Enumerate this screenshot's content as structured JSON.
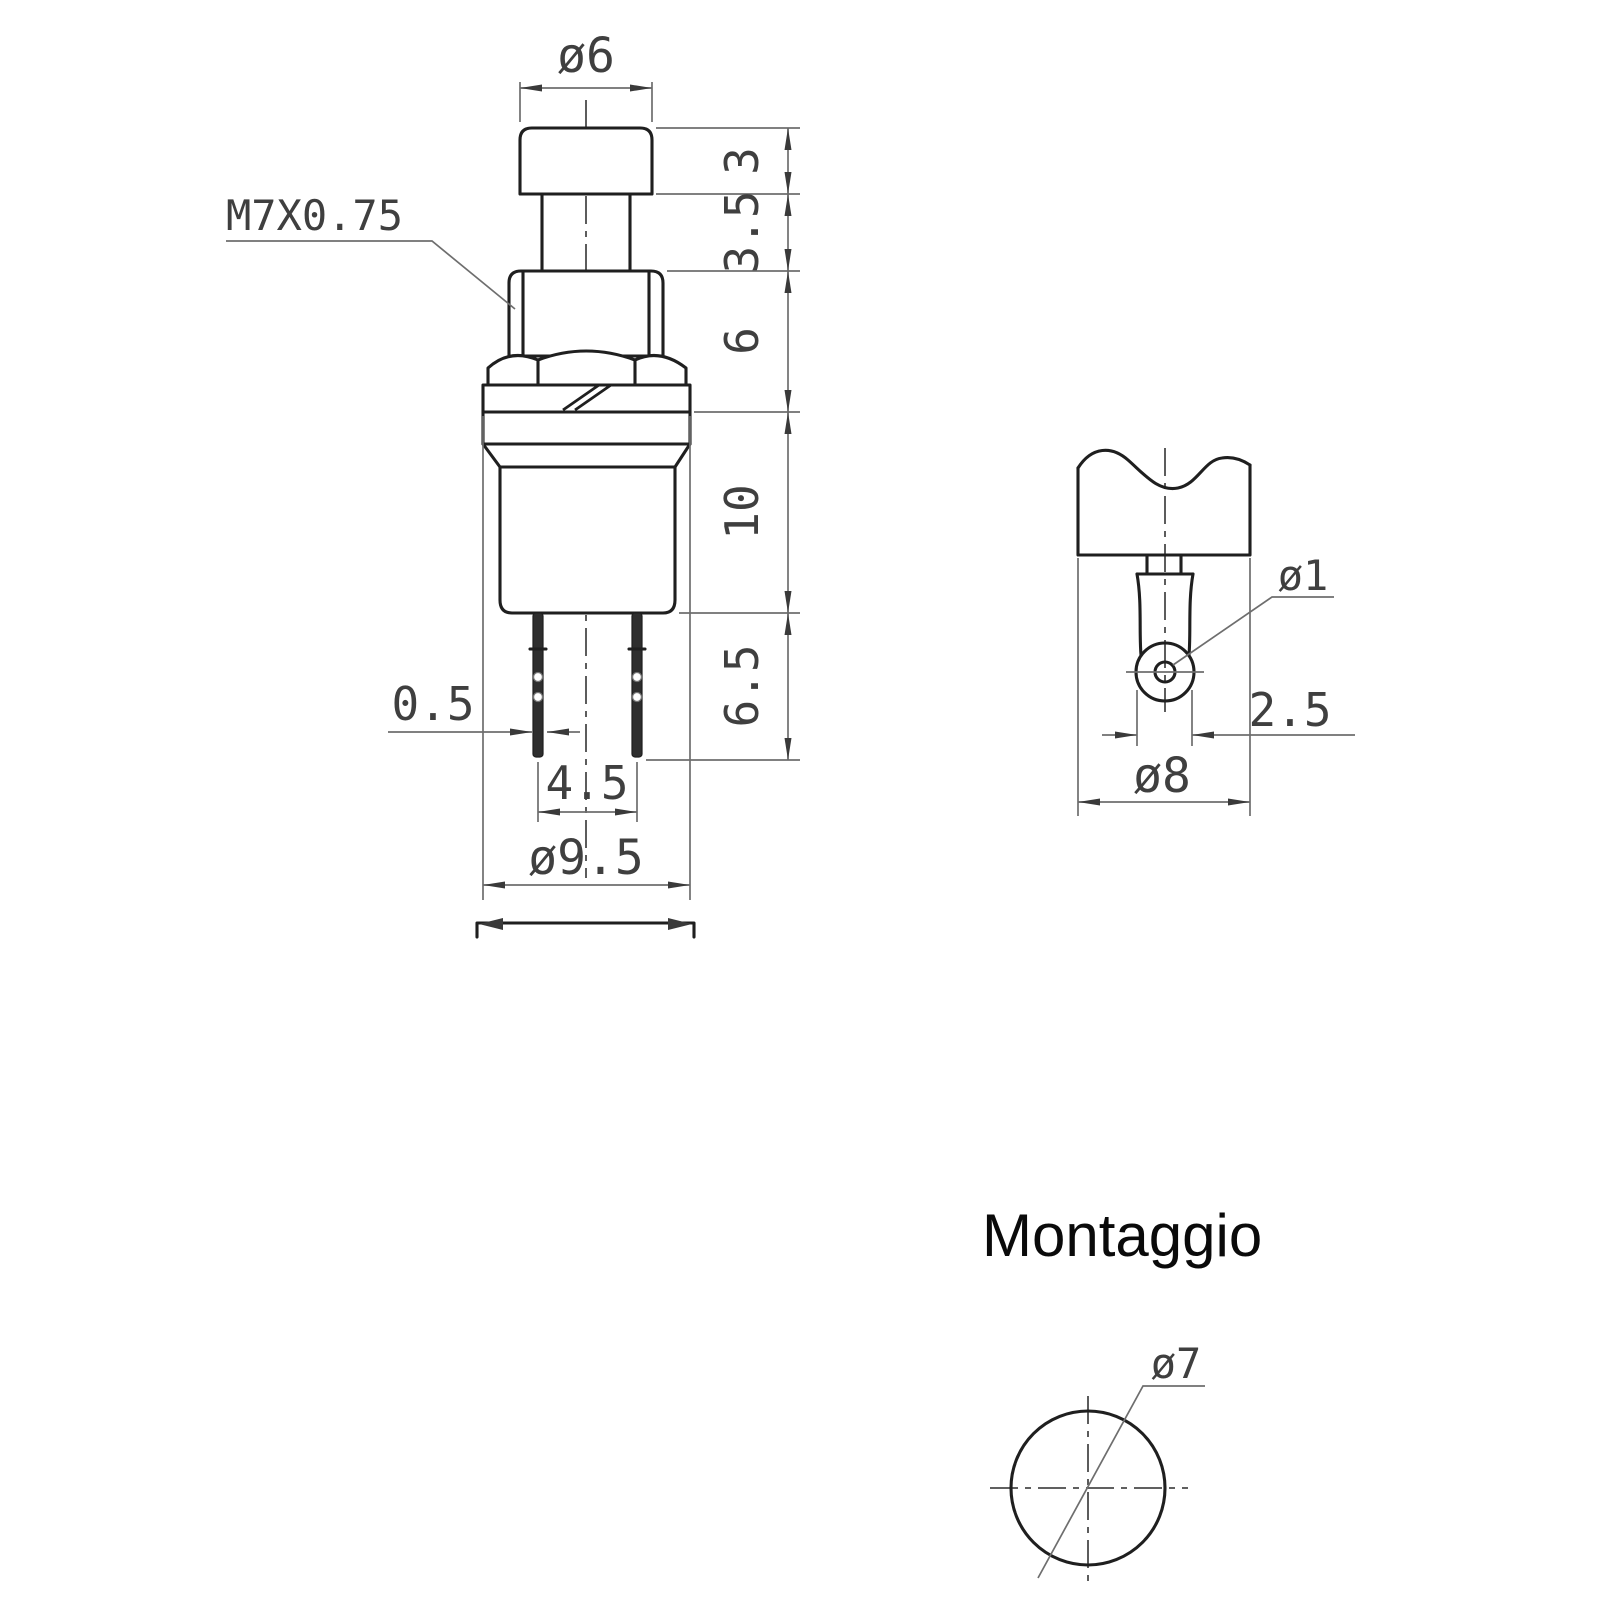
{
  "drawing": {
    "front_view": {
      "cap_diameter": "ø6",
      "thread_spec": "M7X0.75",
      "cap_height": "3",
      "stem_height": "3.5",
      "bushing_height": "6",
      "body_height": "10",
      "terminal_length": "6.5",
      "terminal_thickness": "0.5",
      "terminal_pitch": "4.5",
      "body_diameter": "ø9.5"
    },
    "terminal_detail": {
      "hole_diameter": "ø1",
      "terminal_width": "2.5",
      "housing_diameter": "ø8"
    },
    "mounting": {
      "title": "Montaggio",
      "hole_diameter": "ø7"
    },
    "colors": {
      "outline": "#1f1f1f",
      "dimension_lines": "#6e6e6e",
      "dimension_text": "#3f3f3f",
      "background": "#ffffff"
    }
  }
}
